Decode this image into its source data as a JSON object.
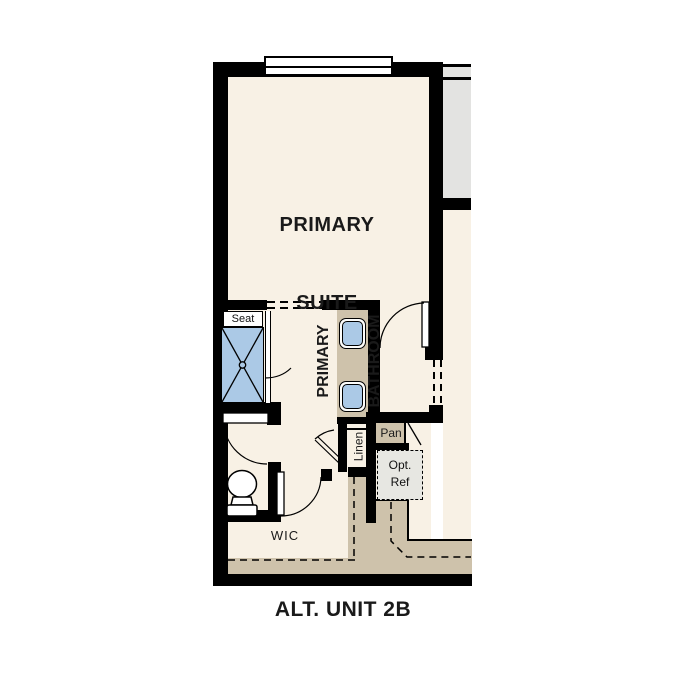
{
  "plan": {
    "title": "ALT. UNIT 2B",
    "rooms": {
      "suite_line1": "PRIMARY",
      "suite_line2": "SUITE",
      "bath_line1": "PRIMARY",
      "bath_line2": "BATHROOM",
      "wic": "WIC"
    },
    "labels": {
      "seat": "Seat",
      "linen": "Linen",
      "pantry": "Pan",
      "ref_line1": "Opt.",
      "ref_line2": "Ref"
    },
    "colors": {
      "wall": "#000000",
      "cream": "#f8f1e5",
      "tan": "#cec2ab",
      "blue": "#abc9e6",
      "gray": "#e3e3e1",
      "refgray": "#e7e7e2"
    }
  }
}
